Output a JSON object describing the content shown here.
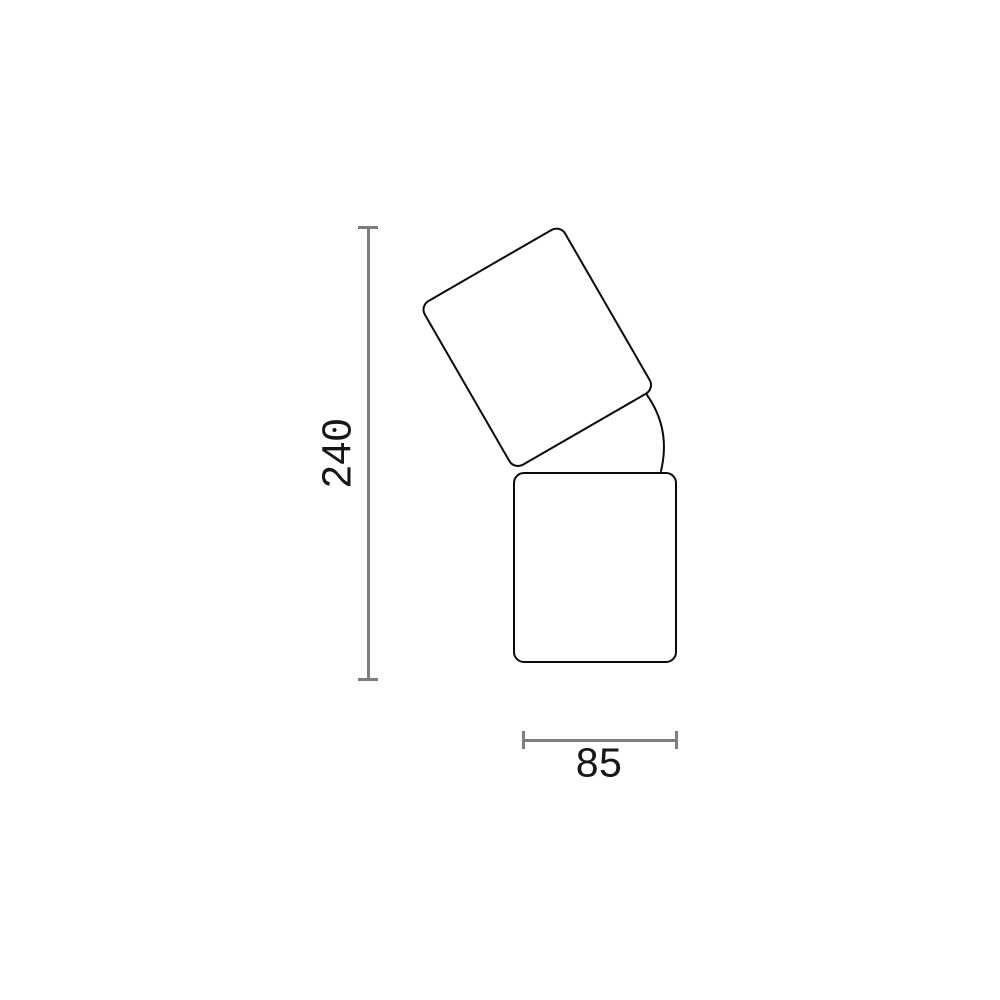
{
  "page": {
    "background_color": "#ffffff"
  },
  "drawing": {
    "kind": "technical-dimension-drawing",
    "outline_color": "#0a0a0a",
    "dimension_line_color": "#7e7e7e",
    "text_color": "#161616",
    "head_tilt_angle_degrees": 30,
    "dimensions": {
      "height": {
        "value": "240",
        "orientation": "vertical",
        "label_rotated": "90deg-counterclockwise",
        "zero_style": "dotted-zero"
      },
      "width": {
        "value": "85",
        "orientation": "horizontal"
      }
    }
  }
}
